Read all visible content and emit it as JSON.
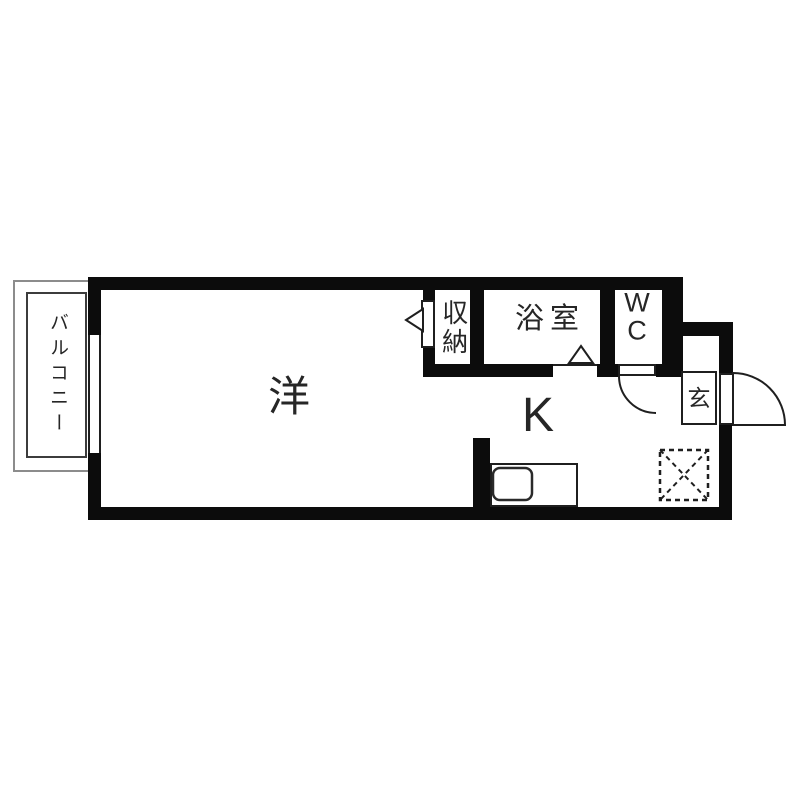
{
  "colors": {
    "wall": "#0c0c0c",
    "line": "#1f1f1f",
    "balcony_outer": "#8c8c8c",
    "balcony_inner": "#3c3c3c",
    "text": "#262626",
    "bg": "#ffffff"
  },
  "plan": {
    "rooms": {
      "balcony": {
        "label": "バルコニー"
      },
      "living": {
        "label": "洋"
      },
      "kitchen": {
        "label": "K"
      },
      "closet": {
        "label": "収納"
      },
      "bathroom": {
        "label": "浴室"
      },
      "toilet": {
        "line1": "W",
        "line2": "C"
      },
      "entrance": {
        "label": "玄"
      }
    }
  }
}
